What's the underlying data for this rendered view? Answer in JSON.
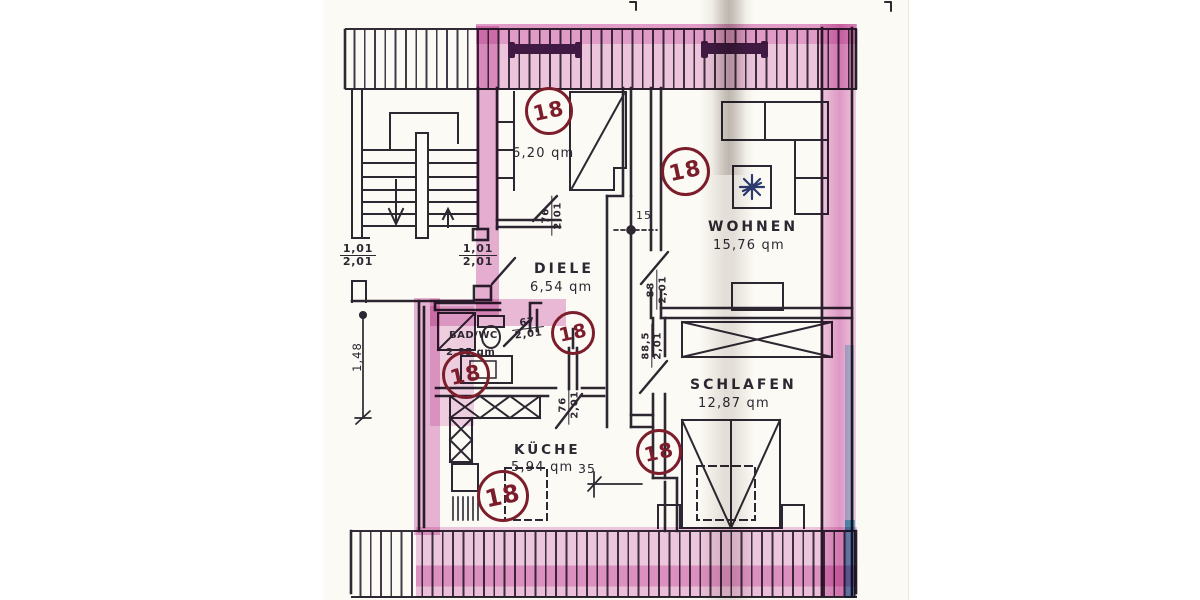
{
  "plan": {
    "unit_marker": "18",
    "rooms": {
      "attic": {
        "area": "6,20 qm"
      },
      "wohnen": {
        "name": "WOHNEN",
        "area": "15,76 qm"
      },
      "diele": {
        "name": "DIELE",
        "area": "6,54 qm"
      },
      "bad": {
        "name": "BAD/WC",
        "area": "2,85 qm"
      },
      "kueche": {
        "name": "KÜCHE",
        "area": "5,94 qm"
      },
      "schlafen": {
        "name": "SCHLAFEN",
        "area": "12,87 qm"
      }
    },
    "dims": {
      "window_left": {
        "num": "1,01",
        "den": "2,01"
      },
      "window_right": {
        "num": "1,01",
        "den": "2,01"
      },
      "door_attic": {
        "num": "76",
        "den": "2,01"
      },
      "door_bad": {
        "num": "67",
        "den": "2,01"
      },
      "door_wohnen": {
        "num": "88",
        "den": "2,01"
      },
      "door_schlafen": {
        "num": "88,5",
        "den": "2,01"
      },
      "door_kueche": {
        "num": "76",
        "den": "2,01"
      },
      "wall_thickness": "15",
      "recess_width": "35",
      "side_length": "1,48"
    },
    "colors": {
      "highlight_pink": "#cb50a8",
      "accent_cyan": "#62c9d6",
      "marker_red": "#7c1d2b",
      "ink": "#2d2731"
    }
  }
}
